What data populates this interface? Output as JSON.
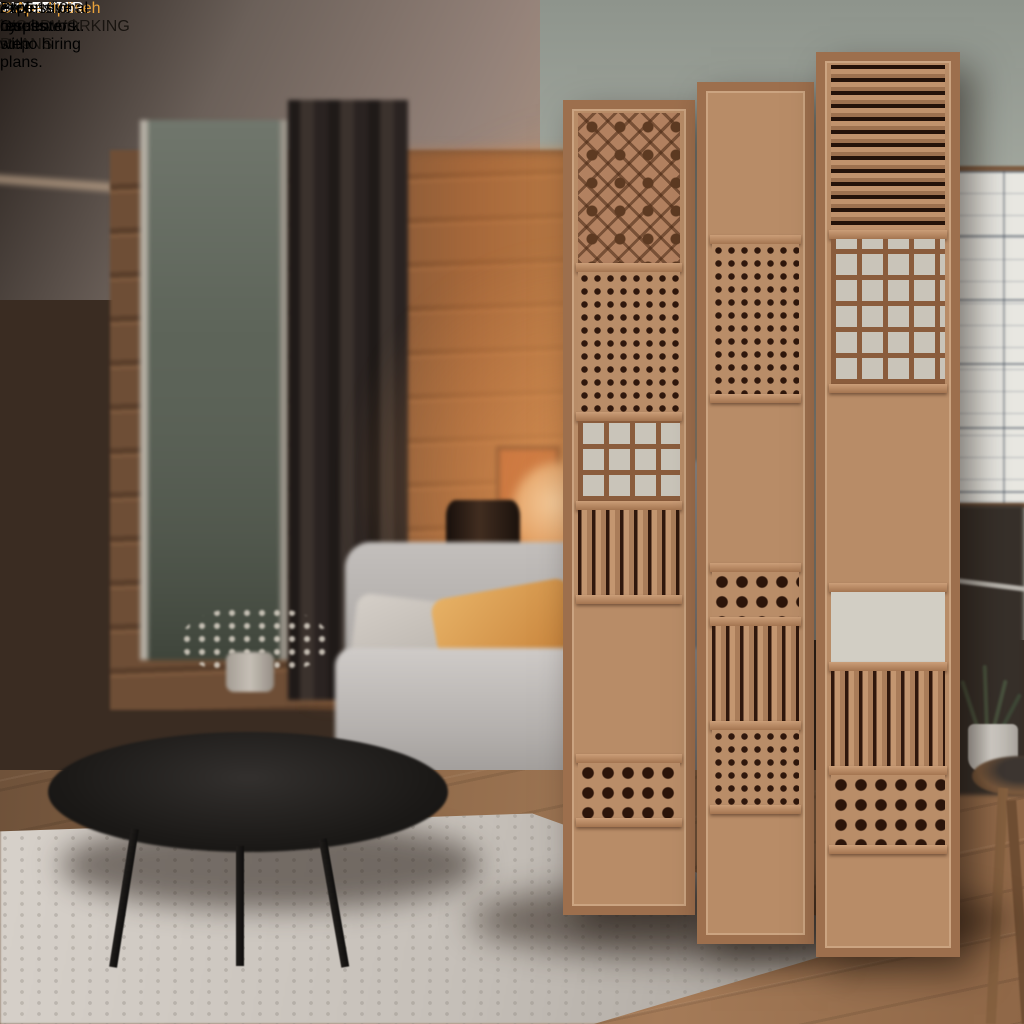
{
  "headline": {
    "lines": [
      "BUILD",
      "DESIGNER",
      "WOODEN",
      "ROOM",
      "DIVIDERS"
    ]
  },
  "subheadline": {
    "lines": [
      "Step-by-step plans.",
      "Zero Guesswork."
    ]
  },
  "cta": {
    "label": "GET 16.0 WOODWORKING PLANS",
    "icon": "chevron-right-icon"
  },
  "caption": {
    "text": "C Ape.Itpöseh"
  },
  "footer": {
    "lines": [
      "Professional results witho hiring",
      "expensive carpenters."
    ]
  },
  "colors": {
    "cta_background": "#ECB44E",
    "cta_text": "#181410",
    "caption_orange": "#E9A23B",
    "headline_white": "#FFFFFF",
    "divider_wood": "#B88C67"
  }
}
